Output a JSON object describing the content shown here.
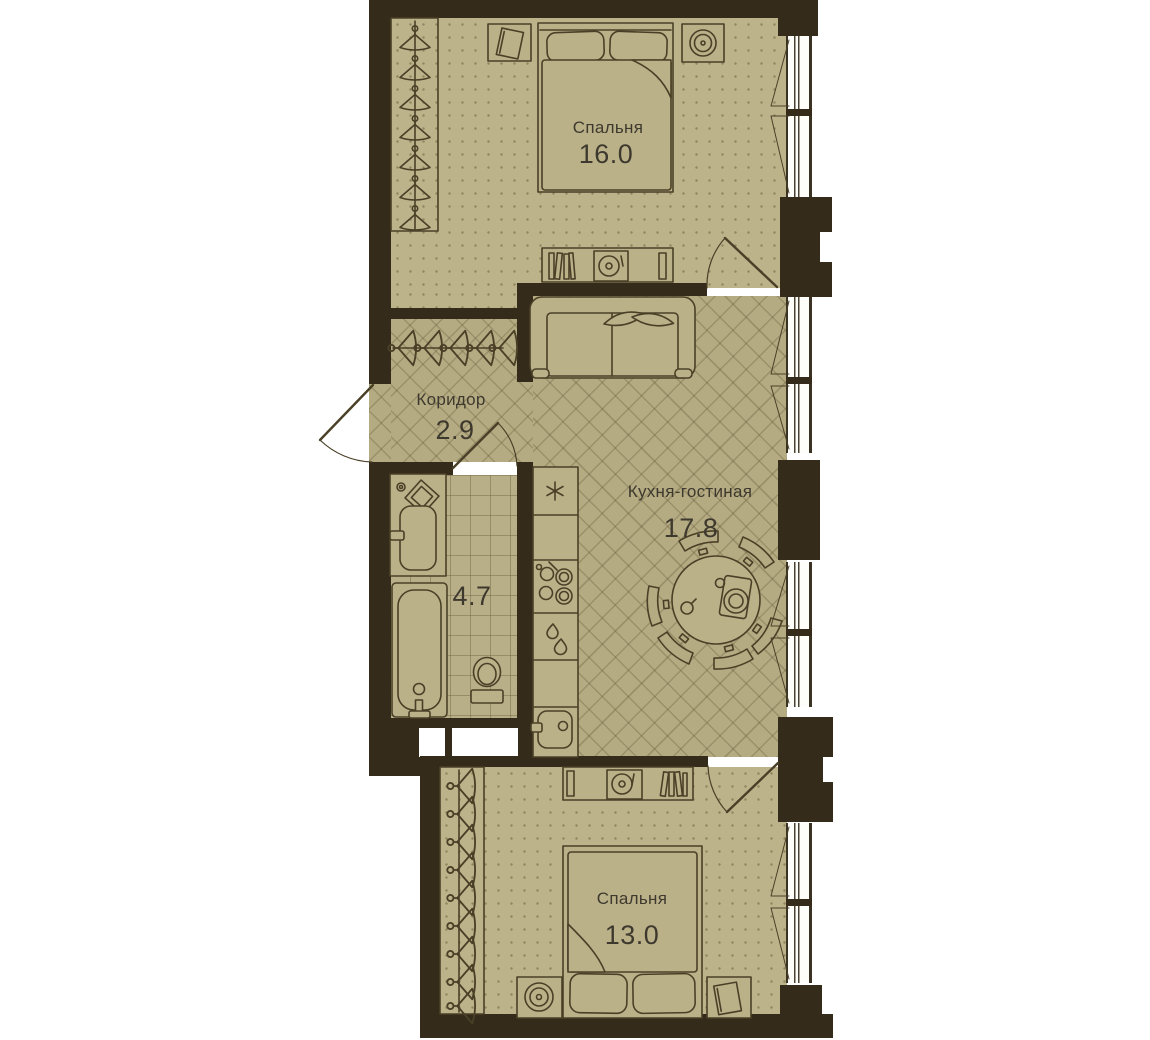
{
  "plan": {
    "rooms": [
      {
        "id": "bedroom-1",
        "name": "Спальня",
        "area": "16.0"
      },
      {
        "id": "corridor",
        "name": "Коридор",
        "area": "2.9"
      },
      {
        "id": "kitchen-living",
        "name": "Кухня-гостиная",
        "area": "17.8"
      },
      {
        "id": "bathroom",
        "name": "",
        "area": "4.7"
      },
      {
        "id": "bedroom-2",
        "name": "Спальня",
        "area": "13.0"
      }
    ],
    "colors": {
      "wall": "#352b1b",
      "floor_dotted": "#bdb38b",
      "floor_parquet": "#b5ab82",
      "floor_tile": "#b8ae87",
      "outline": "#4a4027",
      "text": "#3e392e",
      "background": "#ffffff"
    },
    "furniture_symbols": {
      "bedroom-1": [
        "wardrobe-hangers",
        "nightstand-book",
        "double-bed",
        "speaker",
        "media-shelf-turntable"
      ],
      "corridor": [
        "coat-rack-hangers",
        "entry-door"
      ],
      "kitchen-living": [
        "sofa-with-pillows",
        "kitchen-counter",
        "cooktop",
        "sink",
        "round-dining-table",
        "chairs"
      ],
      "bathroom": [
        "washbasin-unit",
        "bathtub",
        "toilet",
        "door"
      ],
      "bedroom-2": [
        "wardrobe-hangers",
        "media-shelf-turntable",
        "double-bed",
        "speaker",
        "nightstand-book"
      ]
    },
    "windows": {
      "count": 4,
      "side": "right"
    }
  }
}
